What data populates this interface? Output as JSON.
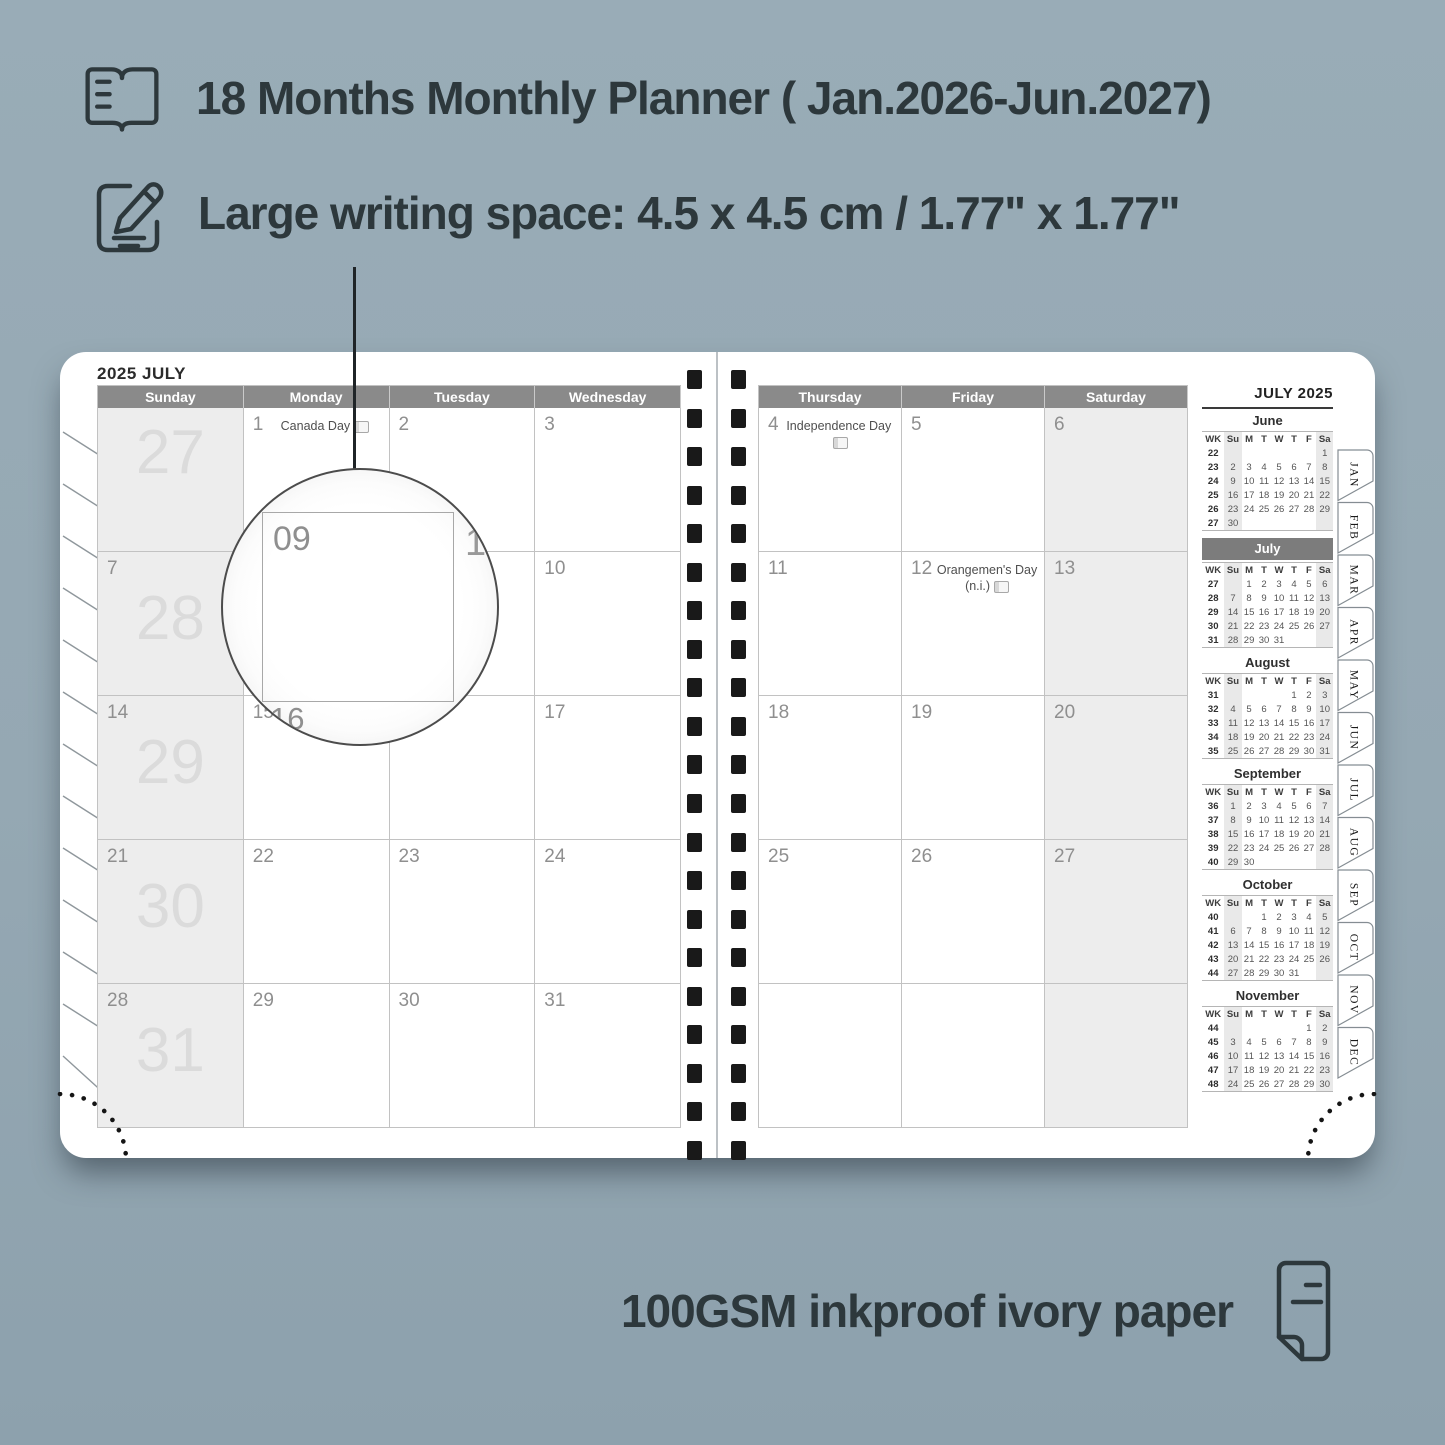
{
  "features": [
    {
      "icon": "open-book-icon",
      "label": "18 Months Monthly Planner ( Jan.2026-Jun.2027)"
    },
    {
      "icon": "compose-icon",
      "label": "Large writing space: 4.5 x 4.5 cm / 1.77\" x 1.77\""
    },
    {
      "icon": "paper-icon",
      "label": "100GSM inkproof ivory paper"
    }
  ],
  "planner": {
    "left_page": {
      "title": "2025 JULY",
      "day_headers": [
        "Sunday",
        "Monday",
        "Tuesday",
        "Wednesday"
      ],
      "rows": [
        {
          "cells": [
            {
              "date": "",
              "week": "27",
              "shaded": true
            },
            {
              "date": "1",
              "holiday": "Canada Day",
              "badge": true
            },
            {
              "date": "2"
            },
            {
              "date": "3"
            }
          ]
        },
        {
          "cells": [
            {
              "date": "7",
              "week": "28",
              "shaded": true
            },
            {
              "date": "8"
            },
            {
              "date": "9"
            },
            {
              "date": "10"
            }
          ]
        },
        {
          "cells": [
            {
              "date": "14",
              "week": "29",
              "shaded": true
            },
            {
              "date": "15"
            },
            {
              "date": "16"
            },
            {
              "date": "17"
            }
          ]
        },
        {
          "cells": [
            {
              "date": "21",
              "week": "30",
              "shaded": true
            },
            {
              "date": "22"
            },
            {
              "date": "23"
            },
            {
              "date": "24"
            }
          ]
        },
        {
          "cells": [
            {
              "date": "28",
              "week": "31",
              "shaded": true
            },
            {
              "date": "29"
            },
            {
              "date": "30"
            },
            {
              "date": "31"
            }
          ]
        }
      ]
    },
    "right_page": {
      "day_headers": [
        "Thursday",
        "Friday",
        "Saturday"
      ],
      "rows": [
        {
          "cells": [
            {
              "date": "4",
              "holiday": "Independence Day",
              "badge": true
            },
            {
              "date": "5"
            },
            {
              "date": "6",
              "shaded": true
            }
          ]
        },
        {
          "cells": [
            {
              "date": "11"
            },
            {
              "date": "12",
              "holiday": "Orangemen's Day (n.i.)",
              "badge": true
            },
            {
              "date": "13",
              "shaded": true
            }
          ]
        },
        {
          "cells": [
            {
              "date": "18"
            },
            {
              "date": "19"
            },
            {
              "date": "20",
              "shaded": true
            }
          ]
        },
        {
          "cells": [
            {
              "date": "25"
            },
            {
              "date": "26"
            },
            {
              "date": "27",
              "shaded": true
            }
          ]
        },
        {
          "cells": [
            {
              "date": ""
            },
            {
              "date": ""
            },
            {
              "date": "",
              "shaded": true
            }
          ]
        }
      ]
    },
    "sidebar": {
      "title": "JULY 2025",
      "weekday_headers": [
        "WK",
        "Su",
        "M",
        "T",
        "W",
        "T",
        "F",
        "Sa"
      ],
      "mini_months": [
        {
          "name": "June",
          "highlight": false,
          "weeks": [
            {
              "wk": "22",
              "days": [
                "",
                "",
                "",
                "",
                "",
                "",
                "1"
              ]
            },
            {
              "wk": "23",
              "days": [
                "2",
                "3",
                "4",
                "5",
                "6",
                "7",
                "8"
              ]
            },
            {
              "wk": "24",
              "days": [
                "9",
                "10",
                "11",
                "12",
                "13",
                "14",
                "15"
              ]
            },
            {
              "wk": "25",
              "days": [
                "16",
                "17",
                "18",
                "19",
                "20",
                "21",
                "22"
              ]
            },
            {
              "wk": "26",
              "days": [
                "23",
                "24",
                "25",
                "26",
                "27",
                "28",
                "29"
              ]
            },
            {
              "wk": "27",
              "days": [
                "30",
                "",
                "",
                "",
                "",
                "",
                ""
              ]
            }
          ]
        },
        {
          "name": "July",
          "highlight": true,
          "weeks": [
            {
              "wk": "27",
              "days": [
                "",
                "1",
                "2",
                "3",
                "4",
                "5",
                "6"
              ]
            },
            {
              "wk": "28",
              "days": [
                "7",
                "8",
                "9",
                "10",
                "11",
                "12",
                "13"
              ]
            },
            {
              "wk": "29",
              "days": [
                "14",
                "15",
                "16",
                "17",
                "18",
                "19",
                "20"
              ]
            },
            {
              "wk": "30",
              "days": [
                "21",
                "22",
                "23",
                "24",
                "25",
                "26",
                "27"
              ]
            },
            {
              "wk": "31",
              "days": [
                "28",
                "29",
                "30",
                "31",
                "",
                "",
                ""
              ]
            }
          ]
        },
        {
          "name": "August",
          "highlight": false,
          "weeks": [
            {
              "wk": "31",
              "days": [
                "",
                "",
                "",
                "",
                "1",
                "2",
                "3"
              ]
            },
            {
              "wk": "32",
              "days": [
                "4",
                "5",
                "6",
                "7",
                "8",
                "9",
                "10"
              ]
            },
            {
              "wk": "33",
              "days": [
                "11",
                "12",
                "13",
                "14",
                "15",
                "16",
                "17"
              ]
            },
            {
              "wk": "34",
              "days": [
                "18",
                "19",
                "20",
                "21",
                "22",
                "23",
                "24"
              ]
            },
            {
              "wk": "35",
              "days": [
                "25",
                "26",
                "27",
                "28",
                "29",
                "30",
                "31"
              ]
            }
          ]
        },
        {
          "name": "September",
          "highlight": false,
          "weeks": [
            {
              "wk": "36",
              "days": [
                "1",
                "2",
                "3",
                "4",
                "5",
                "6",
                "7"
              ]
            },
            {
              "wk": "37",
              "days": [
                "8",
                "9",
                "10",
                "11",
                "12",
                "13",
                "14"
              ]
            },
            {
              "wk": "38",
              "days": [
                "15",
                "16",
                "17",
                "18",
                "19",
                "20",
                "21"
              ]
            },
            {
              "wk": "39",
              "days": [
                "22",
                "23",
                "24",
                "25",
                "26",
                "27",
                "28"
              ]
            },
            {
              "wk": "40",
              "days": [
                "29",
                "30",
                "",
                "",
                "",
                "",
                ""
              ]
            }
          ]
        },
        {
          "name": "October",
          "highlight": false,
          "weeks": [
            {
              "wk": "40",
              "days": [
                "",
                "",
                "1",
                "2",
                "3",
                "4",
                "5"
              ]
            },
            {
              "wk": "41",
              "days": [
                "6",
                "7",
                "8",
                "9",
                "10",
                "11",
                "12"
              ]
            },
            {
              "wk": "42",
              "days": [
                "13",
                "14",
                "15",
                "16",
                "17",
                "18",
                "19"
              ]
            },
            {
              "wk": "43",
              "days": [
                "20",
                "21",
                "22",
                "23",
                "24",
                "25",
                "26"
              ]
            },
            {
              "wk": "44",
              "days": [
                "27",
                "28",
                "29",
                "30",
                "31",
                "",
                ""
              ]
            }
          ]
        },
        {
          "name": "November",
          "highlight": false,
          "weeks": [
            {
              "wk": "44",
              "days": [
                "",
                "",
                "",
                "",
                "",
                "1",
                "2"
              ]
            },
            {
              "wk": "45",
              "days": [
                "3",
                "4",
                "5",
                "6",
                "7",
                "8",
                "9"
              ]
            },
            {
              "wk": "46",
              "days": [
                "10",
                "11",
                "12",
                "13",
                "14",
                "15",
                "16"
              ]
            },
            {
              "wk": "47",
              "days": [
                "17",
                "18",
                "19",
                "20",
                "21",
                "22",
                "23"
              ]
            },
            {
              "wk": "48",
              "days": [
                "24",
                "25",
                "26",
                "27",
                "28",
                "29",
                "30"
              ]
            }
          ]
        }
      ]
    },
    "tabs": [
      "JAN",
      "FEB",
      "MAR",
      "APR",
      "MAY",
      "JUN",
      "JUL",
      "AUG",
      "SEP",
      "OCT",
      "NOV",
      "DEC"
    ],
    "magnifier": {
      "cell_label": "09",
      "partial_right": "1",
      "under_small": "15",
      "under_big": "16"
    }
  },
  "colors": {
    "background": "#96a9b4",
    "page": "#ffffff",
    "header_bar": "#8a8a8a",
    "shaded_cell": "#ededed",
    "mini_highlight_bar": "#7c7c7c",
    "text_dark": "#2d383c",
    "binding_hole": "#191919"
  }
}
